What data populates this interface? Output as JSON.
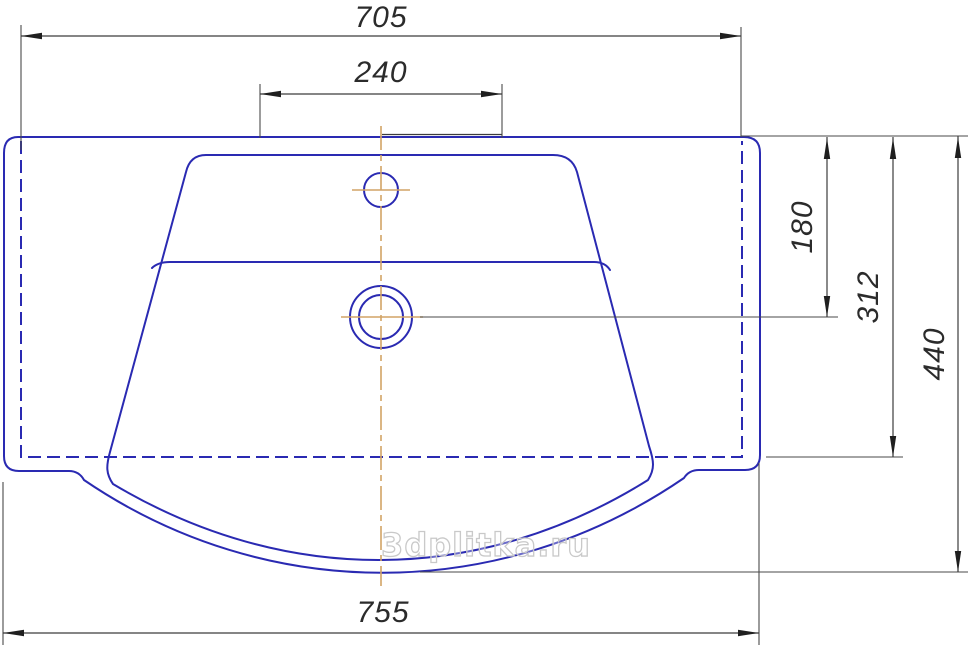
{
  "drawing": {
    "watermark": "3dplitka.ru",
    "dimensions": {
      "back_width": "705",
      "faucet_span": "240",
      "top_to_drain": "180",
      "top_to_back_edge": "312",
      "overall_depth": "440",
      "overall_width": "755"
    },
    "colors": {
      "outline": "#2a2ab2",
      "hidden_line": "#2a2ab2",
      "centerline": "#d2a466",
      "dimension_line": "#3c3c3c",
      "dimension_text": "#2b2b2b",
      "watermark": "#c9c9c9",
      "background": "#ffffff"
    }
  }
}
